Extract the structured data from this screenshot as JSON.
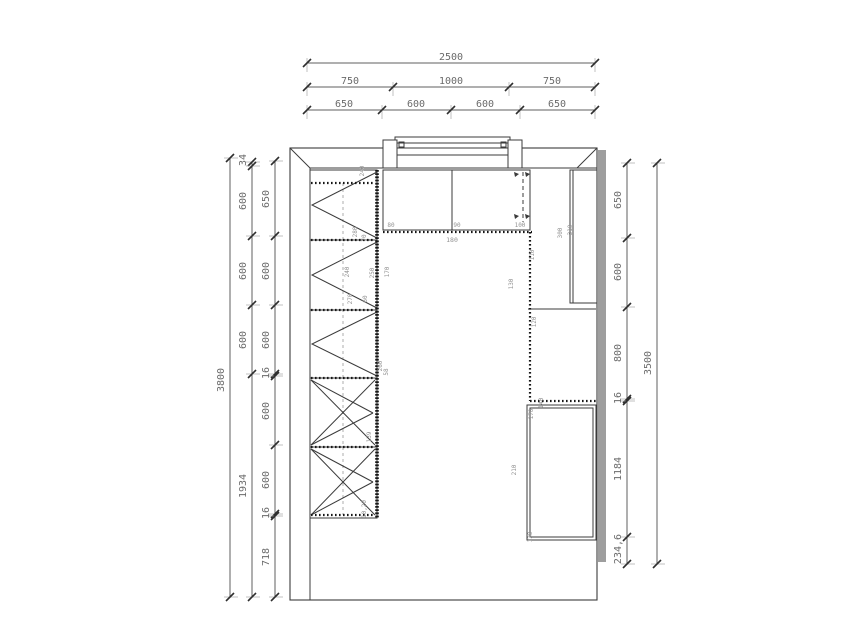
{
  "page": {
    "background": "#ffffff"
  },
  "drawing": {
    "type": "kitchen-floor-plan",
    "colors": {
      "line": "#3b3b3b",
      "wall": "#9e9e9e",
      "counter": "#161616",
      "dim": "#5f5f5f",
      "tick": "#2e2e2e",
      "guide": "#a8a8a8",
      "dimtext": "#6b6b6b",
      "labeltext": "#939393"
    },
    "dim_chains": {
      "top": [
        {
          "name": "overall-width",
          "y": 63,
          "ticks": [
            307,
            595
          ],
          "labels": [
            {
              "t": "2500",
              "x": 451
            }
          ]
        },
        {
          "name": "width-segments-coarse",
          "y": 87,
          "ticks": [
            307,
            393,
            509,
            595
          ],
          "labels": [
            {
              "t": "750",
              "x": 350
            },
            {
              "t": "1000",
              "x": 451
            },
            {
              "t": "750",
              "x": 552
            }
          ]
        },
        {
          "name": "width-segments-fine",
          "y": 110,
          "ticks": [
            307,
            382,
            451,
            520,
            595
          ],
          "labels": [
            {
              "t": "650",
              "x": 344
            },
            {
              "t": "600",
              "x": 416
            },
            {
              "t": "600",
              "x": 485
            },
            {
              "t": "650",
              "x": 557
            }
          ]
        }
      ],
      "left": [
        {
          "name": "overall-height",
          "x": 230,
          "ticks": [
            158,
            597
          ],
          "labels": [
            {
              "t": "3800",
              "y": 380
            }
          ]
        },
        {
          "name": "height-segments-mid",
          "x": 252,
          "ticks": [
            162,
            166,
            236,
            305,
            374,
            597
          ],
          "labels": [
            {
              "t": "34",
              "y": 160
            },
            {
              "t": "600",
              "y": 201
            },
            {
              "t": "600",
              "y": 271
            },
            {
              "t": "600",
              "y": 340
            },
            {
              "t": "1934",
              "y": 486
            }
          ]
        },
        {
          "name": "height-segments-fine",
          "x": 275,
          "ticks": [
            161,
            236,
            305,
            374,
            376,
            445,
            514,
            516,
            597
          ],
          "labels": [
            {
              "t": "650",
              "y": 199
            },
            {
              "t": "600",
              "y": 271
            },
            {
              "t": "600",
              "y": 340
            },
            {
              "t": "16",
              "y": 373
            },
            {
              "t": "600",
              "y": 411
            },
            {
              "t": "600",
              "y": 480
            },
            {
              "t": "16",
              "y": 513
            },
            {
              "t": "718",
              "y": 557
            }
          ]
        }
      ],
      "right": [
        {
          "name": "right-wall-segments",
          "x": 627,
          "ticks": [
            163,
            238,
            307,
            399,
            401,
            537,
            564
          ],
          "labels": [
            {
              "t": "650",
              "y": 200
            },
            {
              "t": "600",
              "y": 272
            },
            {
              "t": "800",
              "y": 353
            },
            {
              "t": "16",
              "y": 398
            },
            {
              "t": "1184",
              "y": 469
            },
            {
              "t": "234,6",
              "y": 549
            }
          ]
        },
        {
          "name": "right-wall-height",
          "x": 657,
          "ticks": [
            163,
            564
          ],
          "labels": [
            {
              "t": "3500",
              "y": 363
            }
          ]
        }
      ]
    },
    "plan_labels": [
      {
        "t": "80",
        "x": 391,
        "y": 227,
        "r": "h",
        "s": 6
      },
      {
        "t": "90",
        "x": 457,
        "y": 227,
        "r": "h",
        "s": 6
      },
      {
        "t": "100",
        "x": 520,
        "y": 227,
        "r": "h",
        "s": 6
      },
      {
        "t": "180",
        "x": 452,
        "y": 242,
        "r": "h",
        "s": 6.5
      },
      {
        "t": "240",
        "x": 364,
        "y": 171,
        "r": "v",
        "s": 6
      },
      {
        "t": "280",
        "x": 357,
        "y": 232,
        "r": "v",
        "s": 6
      },
      {
        "t": "70",
        "x": 366,
        "y": 238,
        "r": "v",
        "s": 6
      },
      {
        "t": "240",
        "x": 349,
        "y": 272,
        "r": "v",
        "s": 6
      },
      {
        "t": "250",
        "x": 374,
        "y": 273,
        "r": "v",
        "s": 6
      },
      {
        "t": "170",
        "x": 389,
        "y": 272,
        "r": "v",
        "s": 6
      },
      {
        "t": "270",
        "x": 352,
        "y": 299,
        "r": "v",
        "s": 6
      },
      {
        "t": "60",
        "x": 367,
        "y": 299,
        "r": "v",
        "s": 6
      },
      {
        "t": "260",
        "x": 382,
        "y": 366,
        "r": "v",
        "s": 6
      },
      {
        "t": "58",
        "x": 388,
        "y": 372,
        "r": "v",
        "s": 6
      },
      {
        "t": "139",
        "x": 371,
        "y": 437,
        "r": "v",
        "s": 6
      },
      {
        "t": "10,20",
        "x": 366,
        "y": 509,
        "r": "v",
        "s": 6
      },
      {
        "t": "110",
        "x": 534,
        "y": 255,
        "r": "v",
        "s": 6
      },
      {
        "t": "130",
        "x": 513,
        "y": 284,
        "r": "v",
        "s": 6
      },
      {
        "t": "300",
        "x": 562,
        "y": 233,
        "r": "v",
        "s": 6
      },
      {
        "t": "310",
        "x": 572,
        "y": 230,
        "r": "v",
        "s": 6
      },
      {
        "t": "120",
        "x": 536,
        "y": 322,
        "r": "v",
        "s": 6
      },
      {
        "t": "210",
        "x": 516,
        "y": 470,
        "r": "v",
        "s": 6
      },
      {
        "t": "170",
        "x": 533,
        "y": 414,
        "r": "v",
        "s": 6
      },
      {
        "t": "140",
        "x": 543,
        "y": 403,
        "r": "v",
        "s": 6
      },
      {
        "t": "120",
        "x": 532,
        "y": 537,
        "r": "v",
        "s": 6
      }
    ]
  }
}
